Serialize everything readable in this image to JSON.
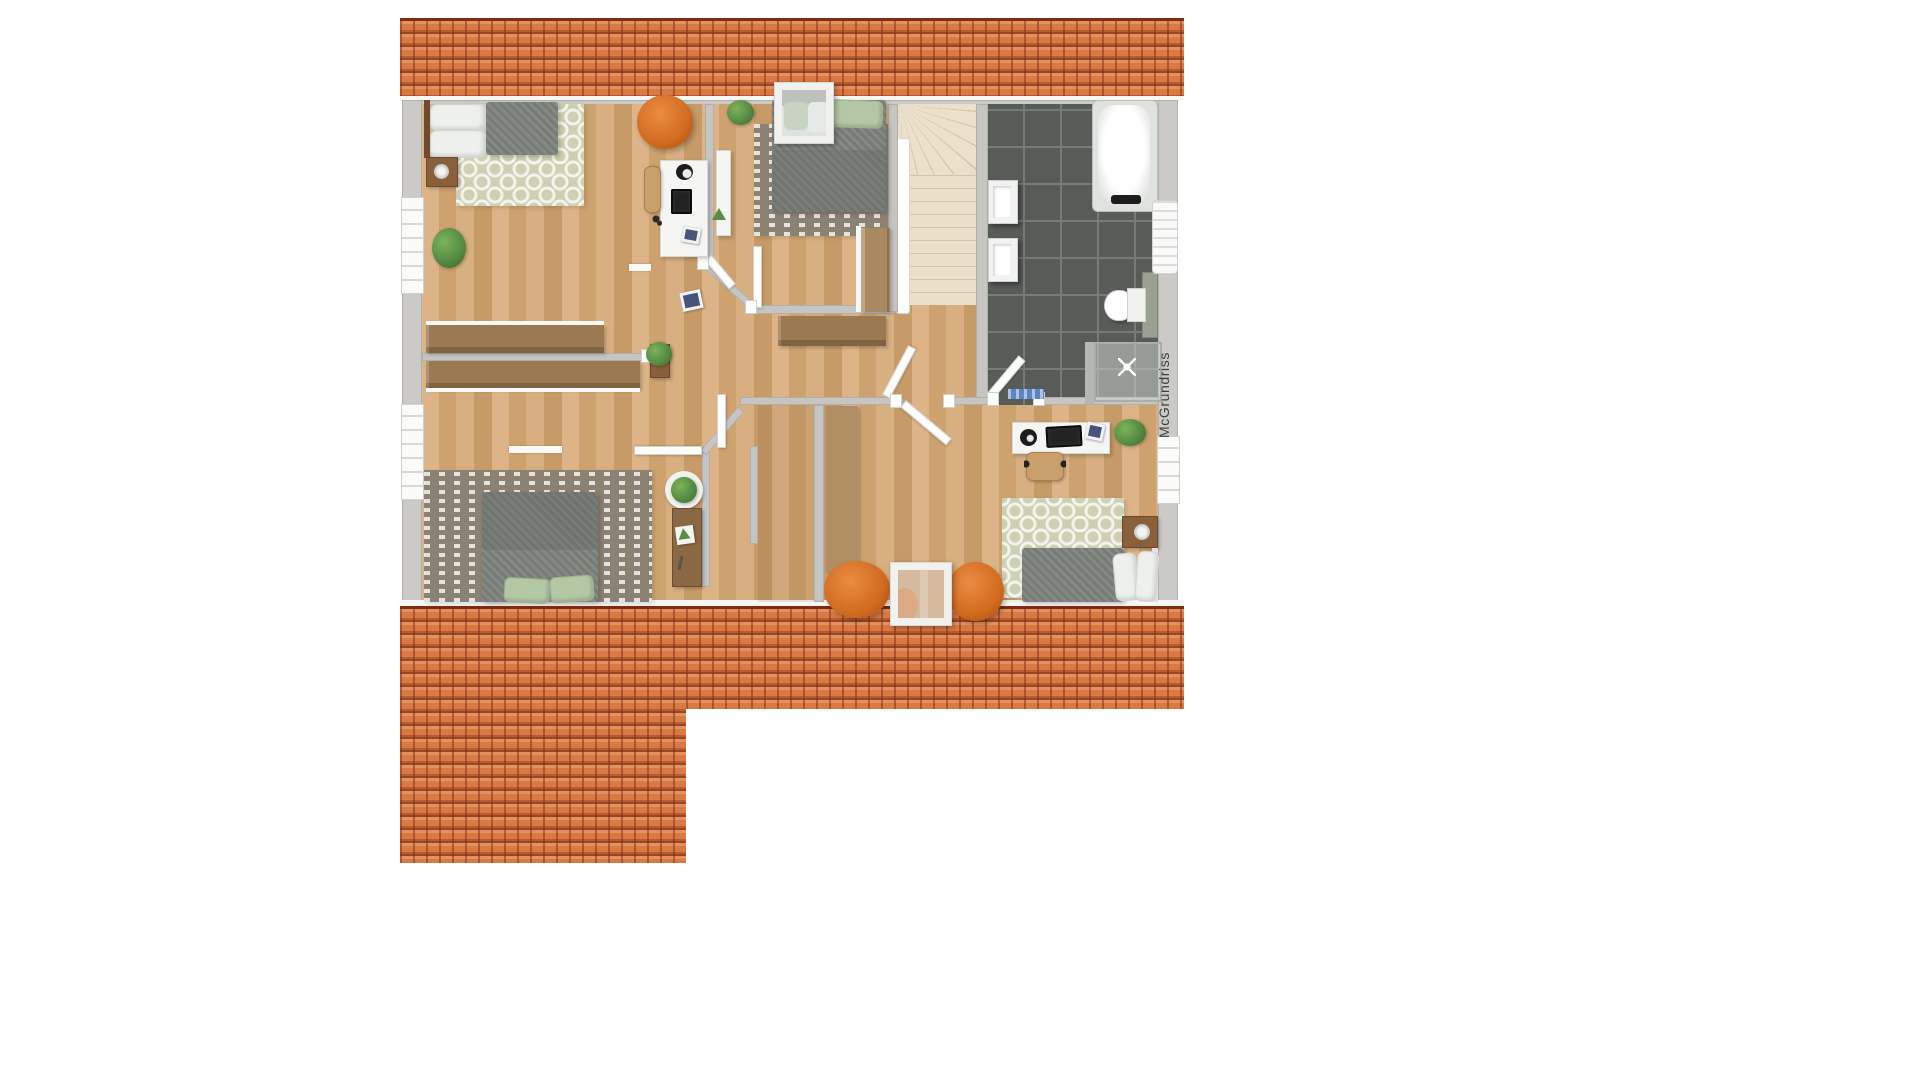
{
  "watermark": {
    "label": "McGrundriss"
  },
  "palette": {
    "roof_tile": "#d97a45",
    "roof_shadow": "#7e2c12",
    "wood_floor": "#d0a877",
    "wall_gray": "#c6c5c2",
    "bathroom_tile": "#575c59",
    "tile_grout": "#767b77",
    "stairs_cream": "#ebdfcb",
    "pouf_orange": "#d06a1e",
    "rug_ogee_green": "#cdd0b2",
    "rug_taupe": "#8b8274",
    "mattress_gray": "#7d827c",
    "pillow_green": "#b4c7a5",
    "pillow_white": "#eef0ee",
    "plant_green": "#4f8540",
    "bathmat_blue": "#5b85c4",
    "furniture_wood": "#a9895f"
  },
  "scene": {
    "type": "floor-plan-render",
    "storey": "attic",
    "objects": [
      "roof-strip-top",
      "roof-strip-bottom-left",
      "roof-strip-bottom-right",
      "bedroom-top-left",
      "bedroom-top-middle",
      "bedroom-bottom-left",
      "bedroom-bottom-right",
      "bathroom",
      "staircase",
      "hallway",
      "double-bed",
      "single-bed",
      "desk",
      "office-chair",
      "wardrobe",
      "sideboard",
      "bathtub",
      "washbasin",
      "toilet",
      "shower",
      "towel-radiator",
      "skylight-window",
      "pouf",
      "potted-plant",
      "rug"
    ]
  }
}
